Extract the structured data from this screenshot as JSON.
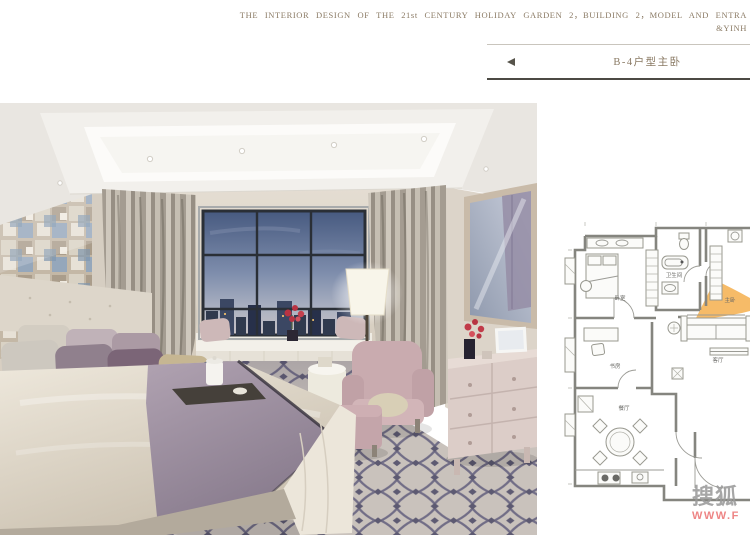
{
  "header": {
    "line1": "THE  INTERIOR  DESIGN  OF  THE  21st  CENTURY  HOLIDAY  GARDEN  2，BUILDING 2，MODEL AND ENTRA",
    "line2": "&YINH"
  },
  "title_bar": {
    "title": "B-4户型主卧",
    "back_arrow_icon": "left-triangle"
  },
  "photo": {
    "subject": "master bedroom rendering"
  },
  "floor_plan": {
    "rooms": [
      {
        "label": "卧室"
      },
      {
        "label": "卫生间"
      },
      {
        "label": "主卧"
      },
      {
        "label": "书房"
      },
      {
        "label": "餐厅"
      },
      {
        "label": "客厅"
      }
    ]
  },
  "watermark": {
    "brand": "搜狐",
    "url": "WWW.F"
  },
  "colors": {
    "header_text": "#8a7a64",
    "title_text": "#8a7a64",
    "rule_light": "#c9c5bd",
    "rule_dark": "#4c4a44",
    "arrow": "#56534a",
    "plan_line": "#85857f",
    "plan_highlight": "#f3a83d",
    "watermark_gray": "#9a9a9a",
    "watermark_red": "#ee8585"
  }
}
